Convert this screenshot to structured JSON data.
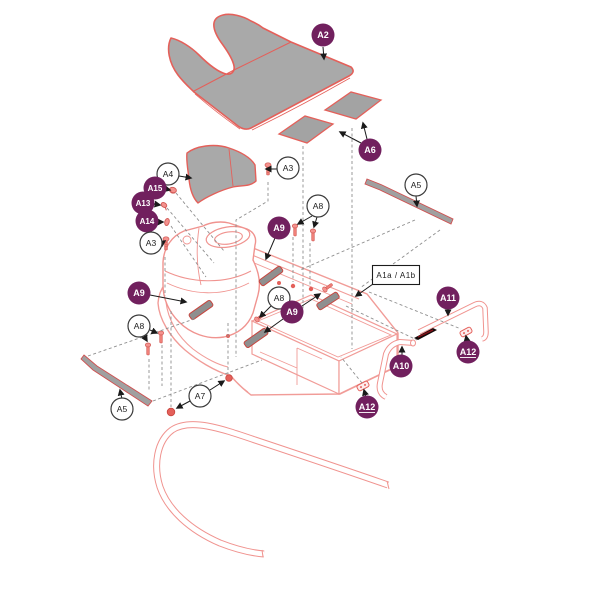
{
  "diagram": {
    "frame_box_label": "A1a / A1b"
  },
  "colors": {
    "badge_purple": "#71205E",
    "part_outline_red": "#E4605A",
    "line_art_pink": "#F19C98",
    "mat_gray": "#A9A9A9",
    "pad_gray": "#8F8F8F",
    "screw_pink": "#F08078",
    "bumper_pad_black": "#140A0A",
    "dashed_gray": "#8F8F8F",
    "arrow_black": "#1A1A1A"
  },
  "callouts": [
    {
      "label": "A2",
      "style": "purple"
    },
    {
      "label": "A6",
      "style": "purple"
    },
    {
      "label": "A4",
      "style": "white"
    },
    {
      "label": "A3",
      "style": "white"
    },
    {
      "label": "A15",
      "style": "purple"
    },
    {
      "label": "A13",
      "style": "purple"
    },
    {
      "label": "A14",
      "style": "purple"
    },
    {
      "label": "A3",
      "style": "white"
    },
    {
      "label": "A8",
      "style": "white"
    },
    {
      "label": "A9",
      "style": "purple"
    },
    {
      "label": "A5",
      "style": "white"
    },
    {
      "label": "A1a  /  A1b",
      "style": "box"
    },
    {
      "label": "A9",
      "style": "purple"
    },
    {
      "label": "A8",
      "style": "white"
    },
    {
      "label": "A9",
      "style": "purple"
    },
    {
      "label": "A11",
      "style": "purple"
    },
    {
      "label": "A12",
      "style": "purple"
    },
    {
      "label": "A10",
      "style": "purple"
    },
    {
      "label": "A12",
      "style": "purple"
    },
    {
      "label": "A8",
      "style": "white"
    },
    {
      "label": "A5",
      "style": "white"
    },
    {
      "label": "A7",
      "style": "white"
    }
  ]
}
